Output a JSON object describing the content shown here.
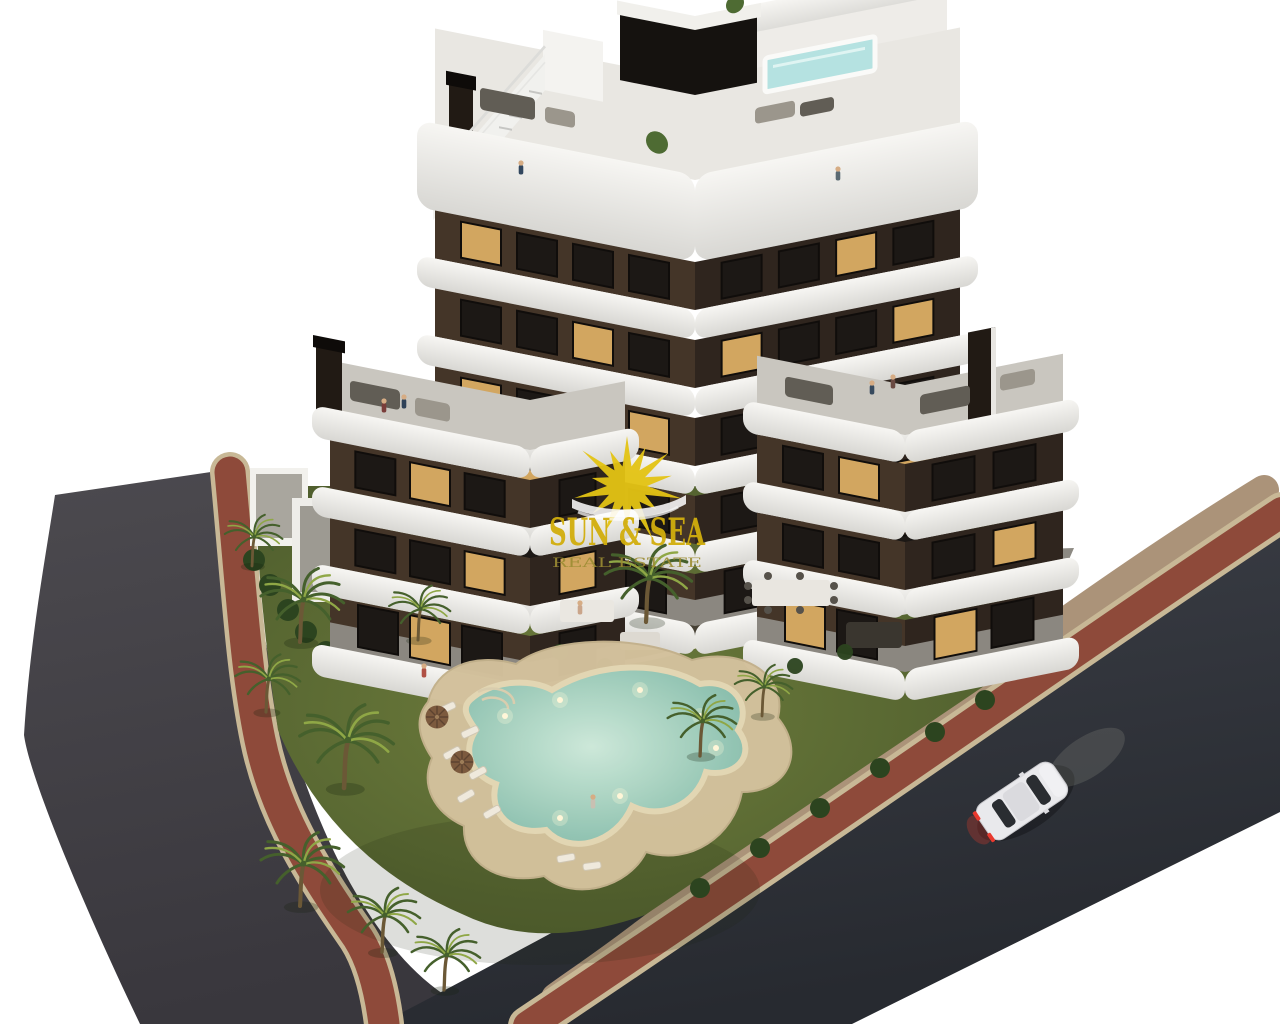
{
  "watermark": {
    "title": "SUN & SEA",
    "subtitle": "REAL ESTATE",
    "icon": "sun-rays-icon"
  },
  "scene": {
    "type": "3d-architectural-render",
    "subject": "aerial view of a modern apartment building with curved white balconies, rooftop plunge pool, garden, free-form swimming pool, palm trees, surrounding streets and a white car"
  },
  "palette": {
    "bg": "#ffffff",
    "roadL": "#454349",
    "roadR": "#2f323a",
    "redwalk": "#8e4a3a",
    "curb": "#c8b896",
    "pavement": "#ab9379",
    "lawn1": "#6b7a3a",
    "lawn2": "#4c5c2b",
    "hedge": "#2c441f",
    "palm1": "#8fa746",
    "palm2": "#45602c",
    "trunk": "#6b5836",
    "sand": "#d3c19c",
    "pool1": "#c4e6d6",
    "pool2": "#7db9a7",
    "facadeL": "#443528",
    "facadeR": "#2f251e",
    "winDark": "#1c1815",
    "winFrame": "#100d0b",
    "winLit": "#d2a660",
    "band1": "#f6f5f2",
    "band2": "#d9d8d4",
    "deckRoof": "#e9e7e2",
    "deckGray": "#c9c6bf",
    "deckGround": "#8b8780",
    "pergola": "#15120f",
    "roofpool": "#b5e2e1",
    "chimney": "#211a14",
    "carBody": "#e9e9ec",
    "carGlass": "#2a2d31",
    "tail": "#e8392e",
    "sun": "#e4c414",
    "title": "#d2ae0d",
    "subtitle": "#9c8d33",
    "soil": "#464034",
    "furnA": "#9b968c",
    "furnB": "#615d55"
  }
}
